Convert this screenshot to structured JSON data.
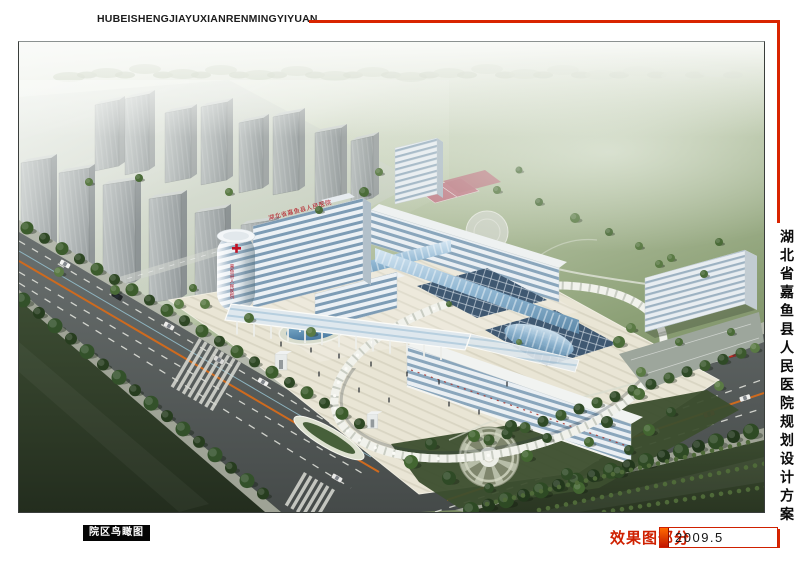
{
  "header": {
    "pinyin_title": "HUBEISHENGJIAYUXIANRENMINGYIYUAN"
  },
  "side_title": {
    "text": "湖北省嘉鱼县人民医院规划设计方案"
  },
  "footer": {
    "view_label": "院区鸟瞰图",
    "section_label": "效果图部分",
    "date": "2009.5"
  },
  "scene": {
    "roof_sign": "湖北省嘉鱼县人民医院",
    "tower_side_sign": "嘉鱼县人民医院"
  },
  "colors": {
    "accent_red": "#d92400",
    "date_box_border": "#cf2000",
    "label_bg": "#000000"
  }
}
